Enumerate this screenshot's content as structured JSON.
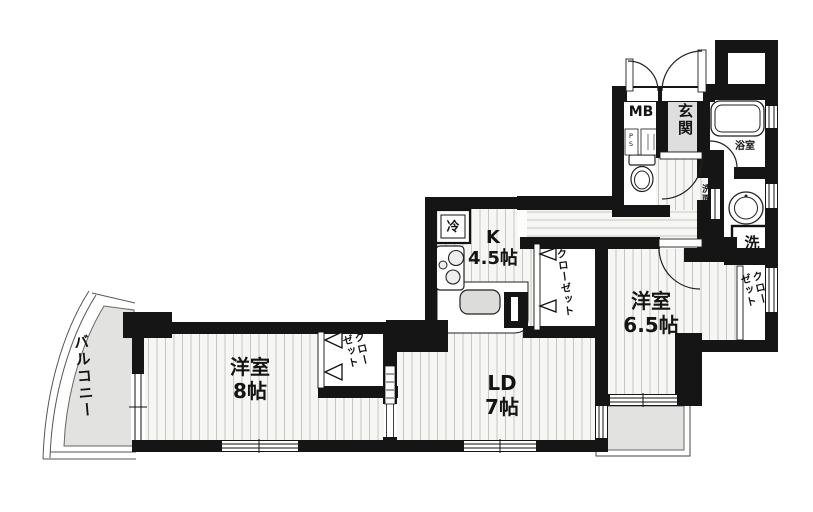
{
  "rooms": {
    "balcony": {
      "label": "バルコニー"
    },
    "bedroom_8": {
      "name": "洋室",
      "size": "8帖"
    },
    "living_dining": {
      "name": "LD",
      "size": "7帖"
    },
    "kitchen": {
      "name": "K",
      "size": "4.5帖"
    },
    "bedroom_6_5": {
      "name": "洋室",
      "size": "6.5帖"
    },
    "entrance": {
      "label": "玄関"
    },
    "bathroom": {
      "label": "浴室"
    },
    "washroom": {
      "label": "洗面脱衣"
    }
  },
  "closets": {
    "bedroom8": {
      "line1": "クロー",
      "line2": "ゼット"
    },
    "hall": {
      "label": "クローゼット"
    },
    "bedroom65": {
      "line1": "クロー",
      "line2": "ゼット"
    }
  },
  "fixtures": {
    "meter_box": "MB",
    "pipe_space": "PS",
    "refrigerator": "冷",
    "washing_machine": "洗"
  },
  "colors": {
    "wall": "#151515",
    "floor": "#f6f6f4",
    "hatch_line": "#c6c6c2",
    "balcony_gray": "#e2e2e0",
    "entrance_gray": "#dedede"
  }
}
